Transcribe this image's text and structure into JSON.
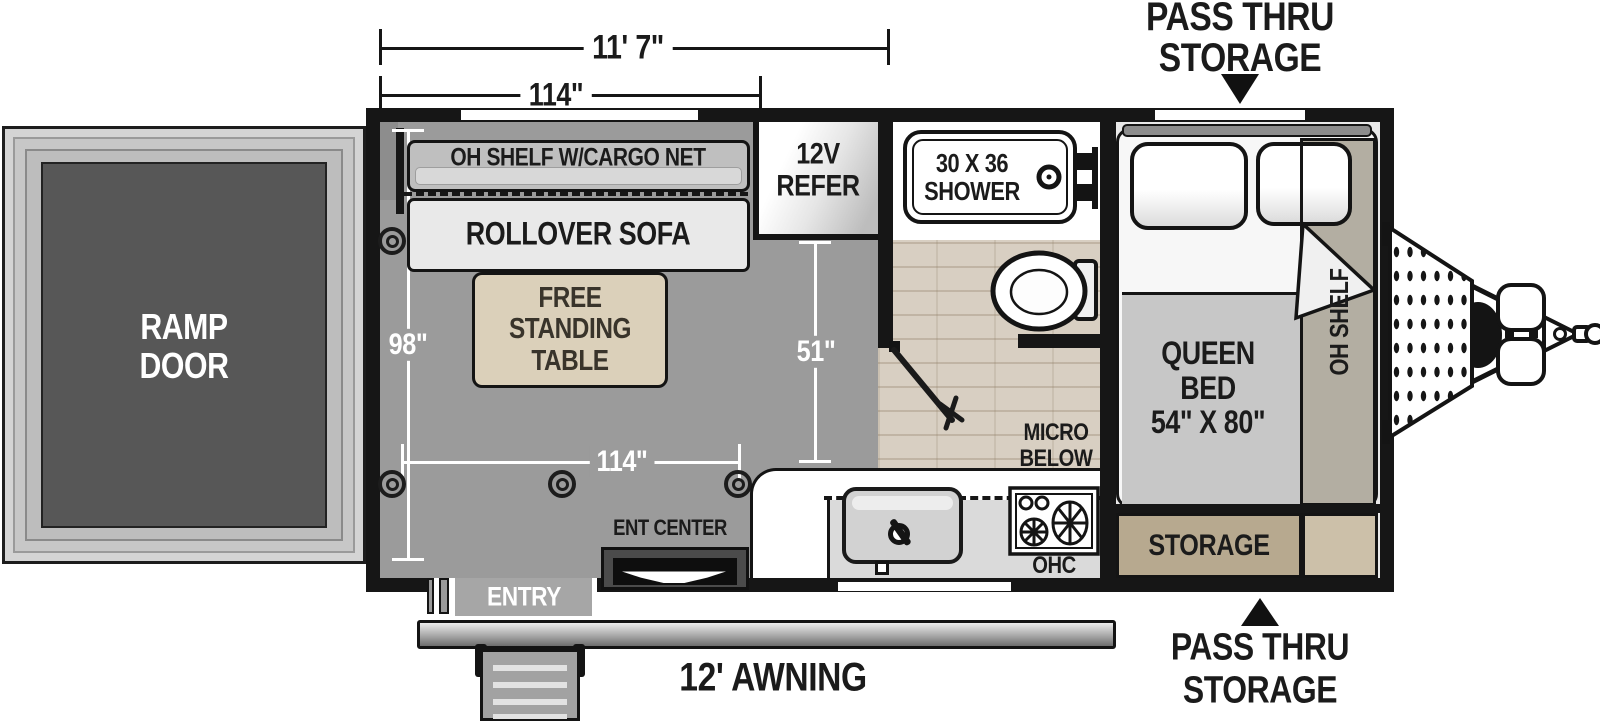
{
  "dims": {
    "overall": "11' 7\"",
    "garage_top": "114\"",
    "width": "98\"",
    "galley": "51\"",
    "garage_bottom": "114\""
  },
  "exterior": {
    "pass_thru_top": "PASS THRU\nSTORAGE",
    "pass_thru_bottom": "PASS THRU\nSTORAGE",
    "awning": "12' AWNING",
    "entry": "ENTRY",
    "ramp_door": "RAMP\nDOOR"
  },
  "garage": {
    "shelf": "OH SHELF W/CARGO NET",
    "sofa": "ROLLOVER SOFA",
    "table": "FREE\nSTANDING\nTABLE",
    "ent_center": "ENT CENTER"
  },
  "galley": {
    "refer": "12V\nREFER",
    "ohc": "OHC",
    "micro": "MICRO\nBELOW"
  },
  "bath": {
    "shower": "30 X 36\nSHOWER"
  },
  "bedroom": {
    "bed": "QUEEN\nBED\n54\" X 80\"",
    "shelf": "OH SHELF",
    "storage": "STORAGE"
  },
  "colors": {
    "wall": "#161616",
    "garage_floor": "#9b9b9b",
    "wood_floor": "#d8cfc2",
    "table_tan": "#dbd0ba",
    "storage_tan": "#b7a98f"
  }
}
